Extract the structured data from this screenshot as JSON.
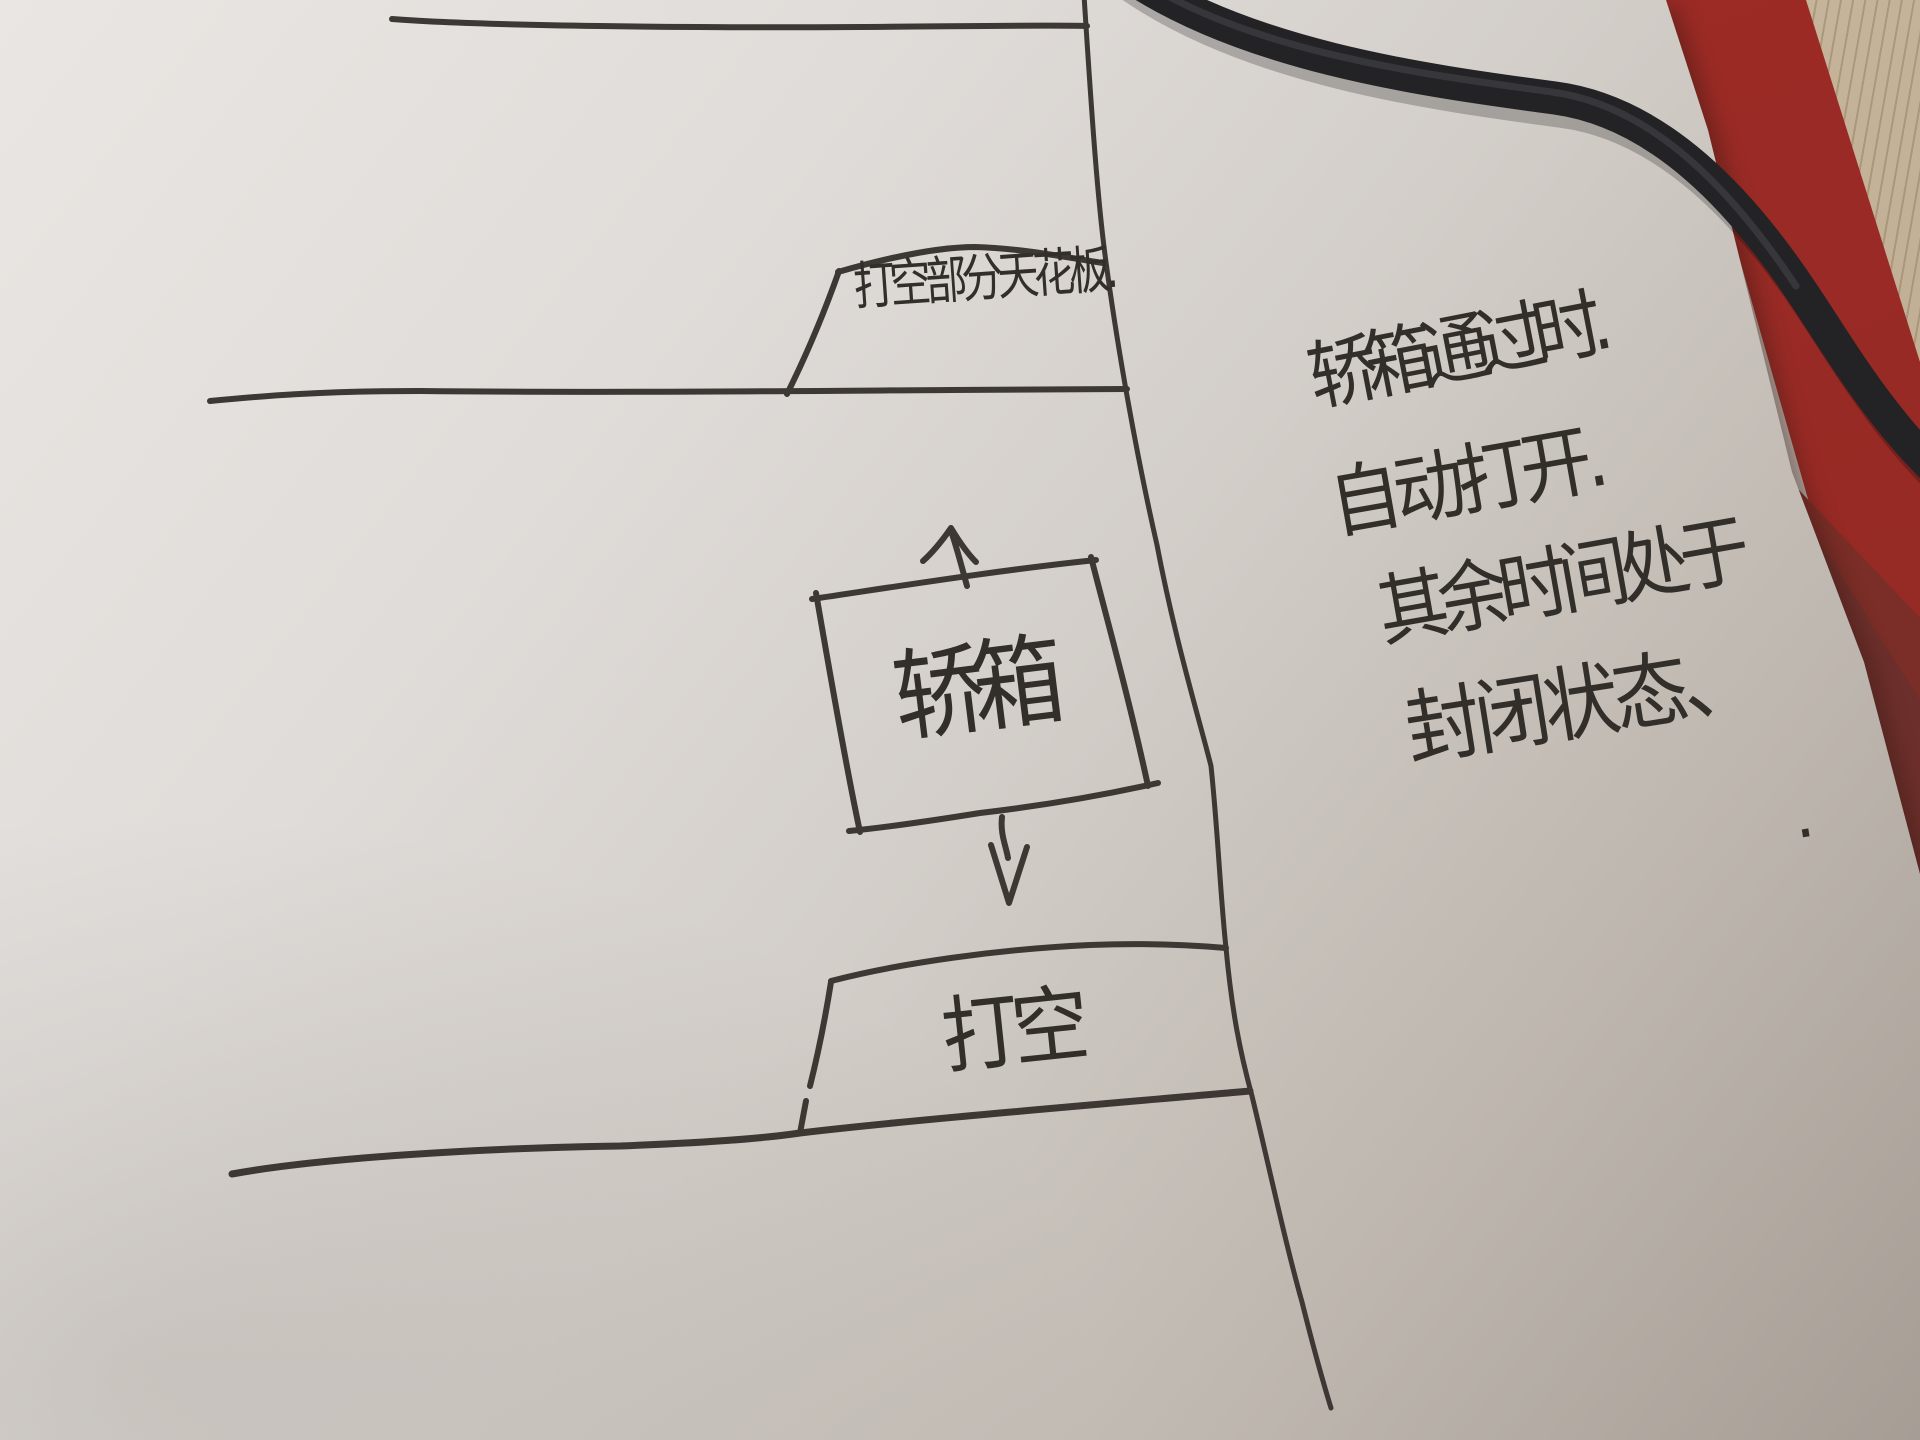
{
  "scene": {
    "description": "Photo of a hand-drawn elevator shaft sketch on paper",
    "objects": [
      "paper-sheet",
      "red-desk-mat",
      "wood-desk",
      "black-cable"
    ]
  },
  "labels": {
    "ceiling": "打空部分天花板.",
    "car": "轿箱",
    "hole": "打空"
  },
  "notes": {
    "line1": "轿箱通过时.",
    "line2": "自动打开.",
    "line3": "其余时间处于",
    "line4": "封闭状态、",
    "period": "."
  },
  "colors": {
    "paper_light": "#e9e6e3",
    "paper_dark": "#a69e95",
    "ink": "#3d3834",
    "mat_red": "#992a25",
    "mat_dark_red": "#6d2f2b",
    "wood": "#c4b298",
    "cable": "#232326"
  }
}
